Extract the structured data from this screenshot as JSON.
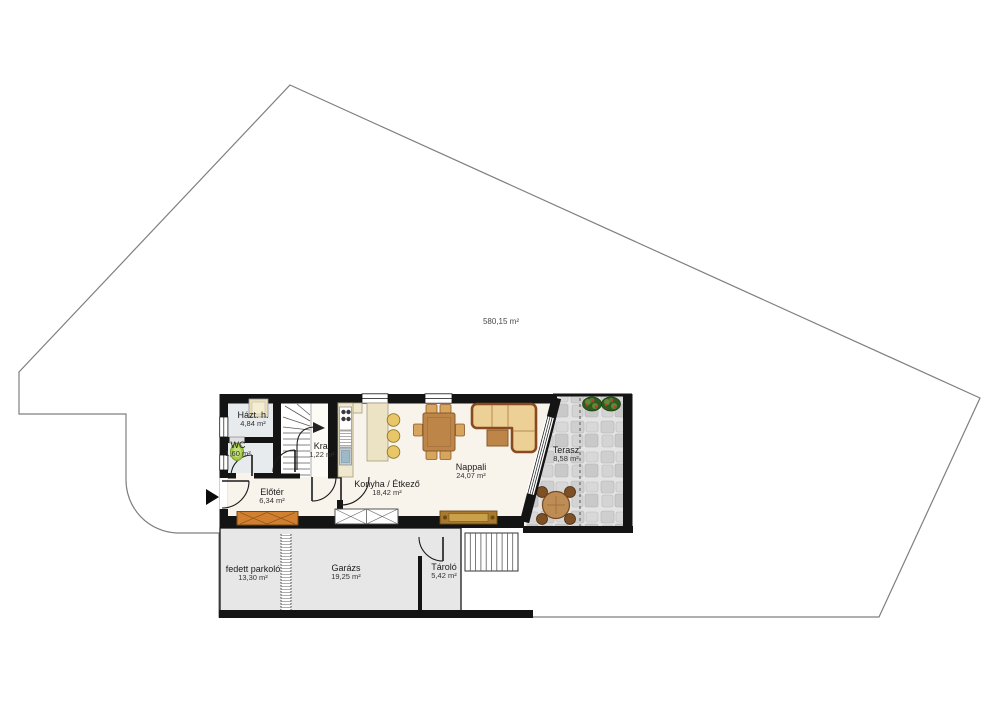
{
  "plan": {
    "plot": {
      "area_label": "580,15 m²"
    },
    "rooms": [
      {
        "name": "Házt. h.",
        "area": "4,84 m²"
      },
      {
        "name": "WC",
        "area": "1,60 m²"
      },
      {
        "name": "Kra.",
        "area": "1,22 m²"
      },
      {
        "name": "Előtér",
        "area": "6,34 m²"
      },
      {
        "name": "Konyha / Étkező",
        "area": "18,42 m²"
      },
      {
        "name": "Nappali",
        "area": "24,07 m²"
      },
      {
        "name": "Terasz",
        "area": "8,58 m²"
      },
      {
        "name": "fedett parkoló",
        "area": "13,30 m²"
      },
      {
        "name": "Garázs",
        "area": "19,25 m²"
      },
      {
        "name": "Tároló",
        "area": "5,42 m²"
      }
    ],
    "icons": [
      "entrance-arrow-icon"
    ],
    "colors": {
      "wall": "#141414",
      "floor": "#f8f4ec",
      "service": "#e7ebed",
      "garage": "#e7e7e7",
      "wood": "#bd8648",
      "wood-light": "#d8a55f",
      "wood-dark": "#8a5a2a",
      "sofa": "#ecd096",
      "bench": "#d2802f",
      "stool": "#e9c668",
      "green": "#a4cb3f",
      "boundary": "#7f7f7f"
    }
  }
}
